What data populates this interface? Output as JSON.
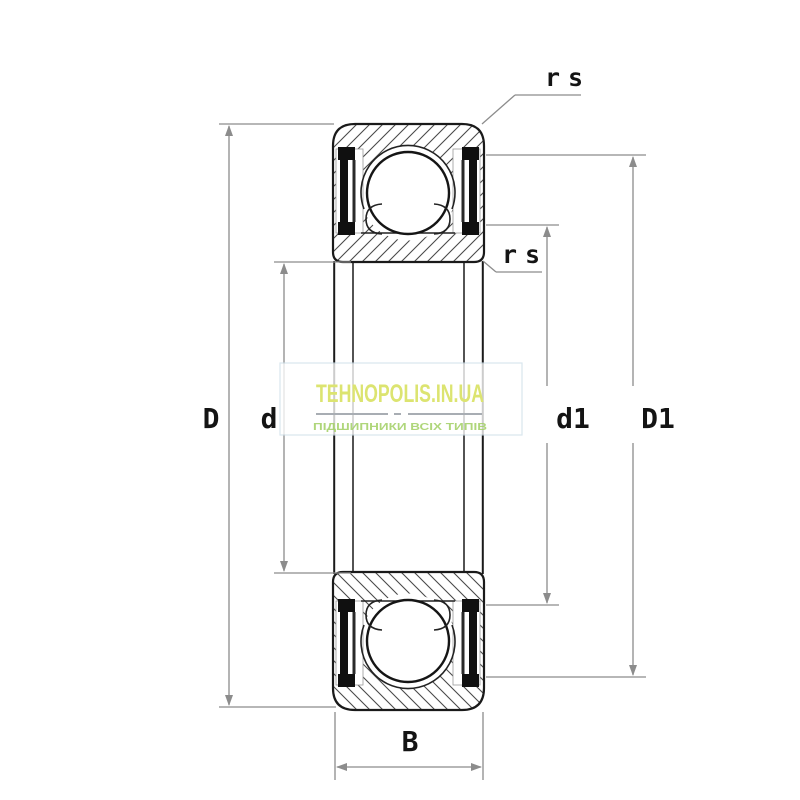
{
  "diagram": {
    "type": "sealed deep groove ball bearing - axial cross-section drawing",
    "dimension_labels": {
      "outer_diameter": "D",
      "bore_diameter": "d",
      "inner_shoulder_diameter": "d1",
      "outer_shoulder_diameter": "D1",
      "width": "B",
      "chamfer_top": "rs",
      "chamfer_bottom": "rs"
    },
    "colors": {
      "drawing_line": "#1a1a1a",
      "hatch_line": "#4a4a4a",
      "dimension_line": "#8c8c8c",
      "label_text": "#141414",
      "watermark_title": "#dce470",
      "watermark_tagline": "#a2d065",
      "watermark_border": "#cfe0ea"
    },
    "watermark": {
      "title": "TEHNOPOLIS.IN.UA",
      "tagline": "ПІДШИПНИКИ ВСІХ ТИПІВ"
    }
  }
}
